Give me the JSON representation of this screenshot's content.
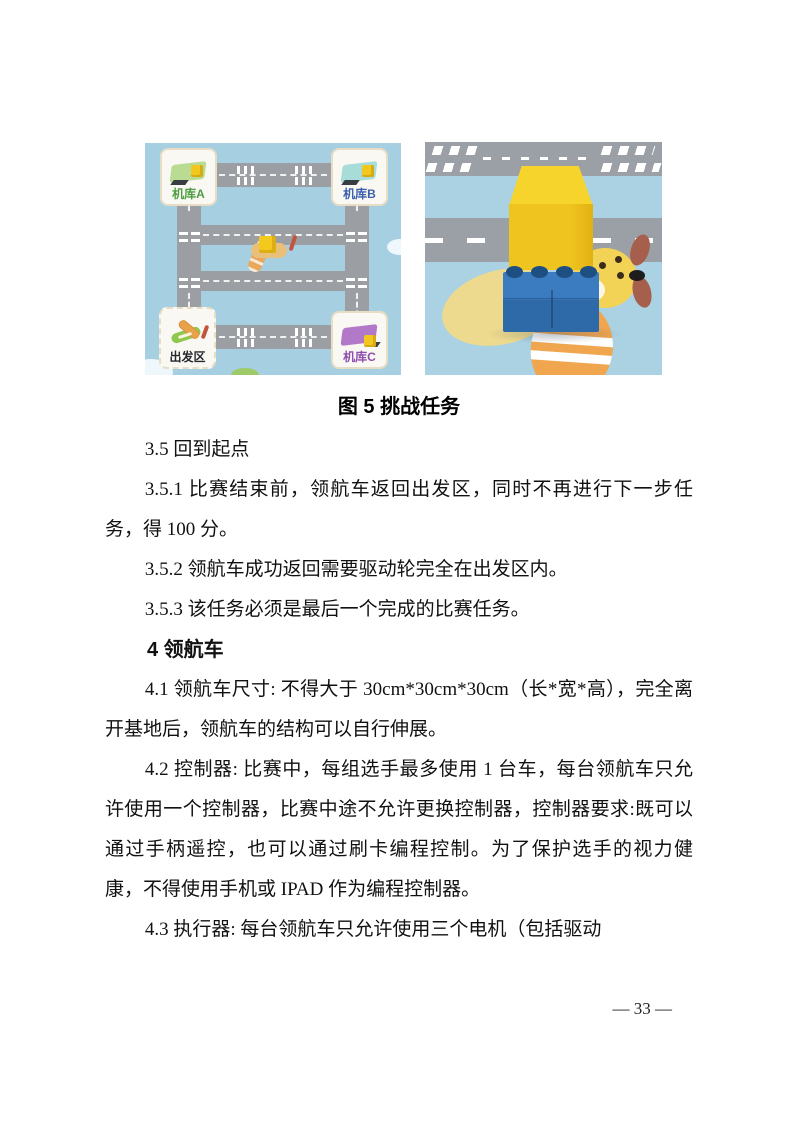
{
  "page": {
    "number_label": "— 33 —"
  },
  "figure": {
    "caption": "图 5 挑战任务",
    "map": {
      "background_color": "#a7cfe2",
      "road_color": "#9b9ea3",
      "tiles": [
        {
          "id": "hangar-a",
          "label": "机库A",
          "label_color": "#4f9e43",
          "icon": "green-hangar-icon"
        },
        {
          "id": "hangar-b",
          "label": "机库B",
          "label_color": "#3c5fae",
          "icon": "teal-hangar-icon"
        },
        {
          "id": "start-zone",
          "label": "出发区",
          "label_color": "#26292d",
          "icon": "toy-plane-icon"
        },
        {
          "id": "hangar-c",
          "label": "机库C",
          "label_color": "#8f4fae",
          "icon": "purple-hangar-icon"
        }
      ],
      "center_object": "plane-with-yellow-cube-icon"
    },
    "photo": {
      "objects": [
        "yellow-cube-icon",
        "blue-brick-icon",
        "cartoon-airplane-icon"
      ],
      "cube_color": "#f0c41f",
      "brick_color": "#3273b4"
    }
  },
  "body": {
    "items": [
      {
        "style": "p",
        "text": "3.5 回到起点"
      },
      {
        "style": "p",
        "text": "3.5.1 比赛结束前，领航车返回出发区，同时不再进行下一步任务，得 100 分。"
      },
      {
        "style": "p",
        "text": "3.5.2 领航车成功返回需要驱动轮完全在出发区内。"
      },
      {
        "style": "p",
        "text": "3.5.3 该任务必须是最后一个完成的比赛任务。"
      },
      {
        "style": "h",
        "text": "4 领航车"
      },
      {
        "style": "p",
        "text": "4.1 领航车尺寸: 不得大于 30cm*30cm*30cm（长*宽*高），完全离开基地后，领航车的结构可以自行伸展。"
      },
      {
        "style": "p",
        "text": "4.2 控制器: 比赛中，每组选手最多使用 1 台车，每台领航车只允许使用一个控制器，比赛中途不允许更换控制器，控制器要求:既可以通过手柄遥控，也可以通过刷卡编程控制。为了保护选手的视力健康，不得使用手机或 IPAD 作为编程控制器。"
      },
      {
        "style": "p",
        "text": "4.3 执行器: 每台领航车只允许使用三个电机（包括驱动"
      }
    ]
  }
}
